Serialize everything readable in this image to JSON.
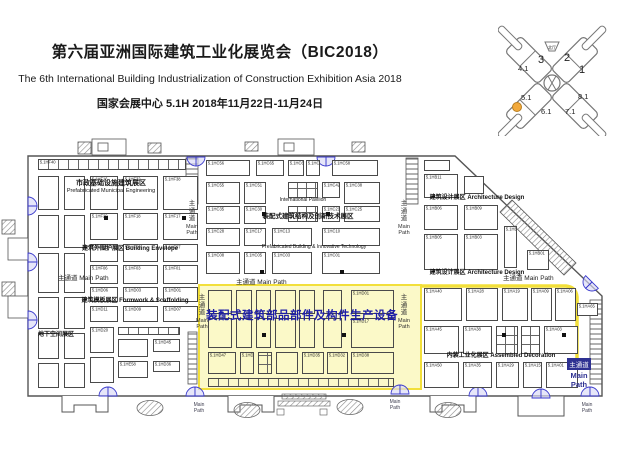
{
  "header": {
    "title_cn": "第六届亚洲国际建筑工业化展览会（BIC2018）",
    "title_en": "The 6th International Building Industrialization of Construction Exhibition Asia 2018",
    "venue_line": "国家会展中心 5.1H 2018年11月22日-11月24日"
  },
  "hall_map": {
    "north": "北厅",
    "labels": [
      {
        "t": "3",
        "x": 40,
        "y": 53,
        "fs": 11
      },
      {
        "t": "2",
        "x": 66,
        "y": 51,
        "fs": 11
      },
      {
        "t": "4.1",
        "x": 20,
        "y": 61,
        "fs": 7.5
      },
      {
        "t": "1",
        "x": 81,
        "y": 63,
        "fs": 11
      },
      {
        "t": "5.1",
        "x": 23,
        "y": 90,
        "fs": 7.5
      },
      {
        "t": "8.1",
        "x": 80,
        "y": 89,
        "fs": 7.5
      },
      {
        "t": "6.1",
        "x": 43,
        "y": 104,
        "fs": 7.5
      },
      {
        "t": "7.1",
        "x": 67,
        "y": 104,
        "fs": 7.5
      }
    ],
    "dot": [
      19,
      97
    ]
  },
  "colors": {
    "yellow-fill": "#FBF9C8",
    "yellow-line": "#F2DF3A",
    "highlight-text": "#1D1DA8",
    "door": "#3A3ACC",
    "dot": "#F2A93B"
  },
  "plan": {
    "highlight_zone_title": "装配式建筑部品部件及构件生产设备",
    "highlight_zone": {
      "x": 198,
      "y": 284,
      "w": 224,
      "h": 106
    },
    "zone_labels": [
      {
        "t": "市政基础设施建筑展区",
        "x": 36,
        "y": 180,
        "w": 150,
        "fs": 7,
        "b": 1
      },
      {
        "t": "Prefabricated Municipal Engineering",
        "x": 16,
        "y": 189,
        "w": 190,
        "fs": 5.5,
        "b": 0
      },
      {
        "t": "建筑外围护展区 Building Envelope",
        "x": 55,
        "y": 246,
        "w": 150,
        "fs": 6,
        "b": 1
      },
      {
        "t": "建筑模板展区 Formwork & Scaffolding",
        "x": 60,
        "y": 298,
        "w": 150,
        "fs": 6,
        "b": 1
      },
      {
        "t": "地下空间展区",
        "x": 30,
        "y": 332,
        "w": 52,
        "fs": 6,
        "b": 1
      },
      {
        "t": "International Pavilion",
        "x": 268,
        "y": 198,
        "w": 70,
        "fs": 5,
        "b": 0
      },
      {
        "t": "装配式建筑结构及创新技术展区",
        "x": 246,
        "y": 214,
        "w": 124,
        "fs": 6.5,
        "b": 1
      },
      {
        "t": "Prefabricated Building & Innovative Technology",
        "x": 236,
        "y": 245,
        "w": 156,
        "fs": 5,
        "b": 0
      },
      {
        "t": "建筑设计展区 Architecture Design",
        "x": 414,
        "y": 195,
        "w": 126,
        "fs": 6,
        "b": 1
      },
      {
        "t": "建筑设计展区 Architecture Design",
        "x": 414,
        "y": 270,
        "w": 126,
        "fs": 6,
        "b": 1
      },
      {
        "t": "内装工业化展区 Assembled Decoration",
        "x": 434,
        "y": 353,
        "w": 134,
        "fs": 6,
        "b": 1
      }
    ],
    "main_path": {
      "cn": "主通道",
      "en": "Main Path",
      "horizontal": [
        [
          58,
          272
        ],
        [
          236,
          276
        ],
        [
          503,
          272
        ]
      ],
      "vertical": [
        [
          184,
          200
        ],
        [
          194,
          294
        ],
        [
          396,
          200
        ],
        [
          396,
          294
        ]
      ],
      "small": [
        [
          186,
          403
        ],
        [
          382,
          400
        ],
        [
          574,
          403
        ]
      ],
      "badge": [
        564,
        354
      ]
    },
    "markers": [
      [
        104,
        216
      ],
      [
        182,
        216
      ],
      [
        262,
        212
      ],
      [
        326,
        212
      ],
      [
        260,
        270
      ],
      [
        340,
        270
      ],
      [
        262,
        333
      ],
      [
        342,
        333
      ],
      [
        502,
        333
      ],
      [
        562,
        333
      ]
    ],
    "booths": [
      [
        38,
        159,
        148,
        11,
        "5.1HF40",
        "s"
      ],
      [
        38,
        176,
        21,
        34,
        ""
      ],
      [
        64,
        176,
        21,
        34,
        ""
      ],
      [
        90,
        176,
        28,
        34,
        "5.1HF16"
      ],
      [
        123,
        176,
        35,
        34,
        "5.1HF32"
      ],
      [
        163,
        176,
        35,
        34,
        "5.1HF38"
      ],
      [
        38,
        215,
        21,
        33,
        ""
      ],
      [
        64,
        215,
        21,
        33,
        ""
      ],
      [
        90,
        213,
        28,
        27,
        "5.1HF29"
      ],
      [
        123,
        213,
        35,
        27,
        "5.1HF18"
      ],
      [
        163,
        213,
        35,
        27,
        "5.1HF17"
      ],
      [
        38,
        253,
        21,
        40,
        ""
      ],
      [
        64,
        253,
        21,
        40,
        ""
      ],
      [
        90,
        244,
        28,
        18,
        "5.1HF15"
      ],
      [
        123,
        244,
        35,
        18,
        "5.1HF09"
      ],
      [
        163,
        244,
        35,
        18,
        "5.1HF07"
      ],
      [
        90,
        265,
        28,
        19,
        "5.1HF06"
      ],
      [
        123,
        265,
        35,
        19,
        "5.1HF03"
      ],
      [
        163,
        265,
        35,
        19,
        "5.1HF01"
      ],
      [
        38,
        297,
        21,
        32,
        ""
      ],
      [
        64,
        297,
        21,
        32,
        ""
      ],
      [
        90,
        287,
        28,
        15,
        "5.1HD06"
      ],
      [
        123,
        287,
        35,
        15,
        "5.1HD03"
      ],
      [
        163,
        287,
        35,
        15,
        "5.1HD01"
      ],
      [
        90,
        306,
        28,
        16,
        "5.1HD11"
      ],
      [
        123,
        306,
        35,
        16,
        "5.1HD09"
      ],
      [
        163,
        306,
        35,
        16,
        "5.1HD07"
      ],
      [
        38,
        333,
        21,
        26,
        ""
      ],
      [
        64,
        333,
        21,
        26,
        ""
      ],
      [
        90,
        327,
        24,
        26,
        "5.1HD20"
      ],
      [
        118,
        327,
        62,
        8,
        "",
        "s"
      ],
      [
        118,
        339,
        30,
        18,
        ""
      ],
      [
        153,
        339,
        27,
        13,
        "5.1HD45"
      ],
      [
        118,
        361,
        30,
        17,
        "5.1HE58"
      ],
      [
        153,
        361,
        27,
        11,
        "5.1HD36"
      ],
      [
        38,
        363,
        21,
        25,
        ""
      ],
      [
        64,
        363,
        21,
        25,
        ""
      ],
      [
        90,
        357,
        24,
        26,
        ""
      ],
      [
        206,
        160,
        44,
        16,
        "5.1HC56"
      ],
      [
        256,
        160,
        28,
        16,
        "5.1HC65"
      ],
      [
        288,
        160,
        16,
        16,
        "5.1HC62"
      ],
      [
        306,
        160,
        14,
        16,
        "5.1HC80"
      ],
      [
        332,
        160,
        46,
        16,
        "5.1HC58"
      ],
      [
        206,
        182,
        34,
        22,
        "5.1HC55"
      ],
      [
        244,
        182,
        22,
        22,
        "5.1HC51"
      ],
      [
        288,
        182,
        30,
        16,
        "",
        "g"
      ],
      [
        322,
        182,
        18,
        16,
        "5.1HC42"
      ],
      [
        344,
        182,
        36,
        22,
        "5.1HC38"
      ],
      [
        206,
        206,
        34,
        18,
        "5.1HC35"
      ],
      [
        244,
        206,
        22,
        18,
        "5.1HC30"
      ],
      [
        288,
        206,
        30,
        16,
        "",
        "g"
      ],
      [
        322,
        206,
        18,
        16,
        "5.1HC21"
      ],
      [
        344,
        206,
        36,
        16,
        "5.1HC25"
      ],
      [
        206,
        228,
        34,
        18,
        "5.1HC28"
      ],
      [
        244,
        228,
        22,
        18,
        "5.1HC17"
      ],
      [
        272,
        228,
        40,
        18,
        "5.1HC13"
      ],
      [
        322,
        228,
        58,
        18,
        "5.1HC10"
      ],
      [
        206,
        252,
        34,
        22,
        "5.1HC08"
      ],
      [
        244,
        252,
        22,
        22,
        "5.1HC05"
      ],
      [
        272,
        252,
        40,
        22,
        "5.1HC03"
      ],
      [
        322,
        252,
        58,
        22,
        "5.1HC01"
      ],
      [
        424,
        160,
        26,
        11,
        ""
      ],
      [
        424,
        174,
        34,
        24,
        "5.1HB11"
      ],
      [
        464,
        176,
        20,
        18,
        ""
      ],
      [
        424,
        205,
        34,
        25,
        "5.1HB06"
      ],
      [
        464,
        205,
        34,
        25,
        "5.1HB09"
      ],
      [
        424,
        234,
        34,
        36,
        "5.1HB05"
      ],
      [
        464,
        234,
        34,
        36,
        "5.1HB03"
      ],
      [
        504,
        226,
        13,
        42,
        "5.1HB02"
      ],
      [
        527,
        250,
        22,
        20,
        "5.1HB01"
      ],
      [
        424,
        288,
        38,
        33,
        "5.1HA40"
      ],
      [
        466,
        288,
        32,
        33,
        "5.1HA28"
      ],
      [
        502,
        288,
        26,
        33,
        "5.1HA19"
      ],
      [
        531,
        288,
        21,
        33,
        "5.1HA09"
      ],
      [
        555,
        288,
        21,
        33,
        "5.1HA06"
      ],
      [
        577,
        303,
        21,
        13,
        "5.1HA65"
      ],
      [
        424,
        326,
        35,
        28,
        "5.1HA45"
      ],
      [
        463,
        326,
        29,
        28,
        "5.1HA38"
      ],
      [
        496,
        326,
        22,
        28,
        "",
        "g"
      ],
      [
        521,
        326,
        19,
        28,
        "",
        "g"
      ],
      [
        544,
        326,
        34,
        28,
        "5.1HA03"
      ],
      [
        424,
        362,
        35,
        26,
        "5.1HA50"
      ],
      [
        463,
        362,
        29,
        26,
        "5.1HA35"
      ],
      [
        496,
        362,
        23,
        26,
        "5.1HA29"
      ],
      [
        523,
        362,
        19,
        26,
        "5.1HA15"
      ],
      [
        546,
        362,
        32,
        26,
        "5.1HA01"
      ],
      [
        208,
        290,
        24,
        24,
        "",
        "y"
      ],
      [
        236,
        290,
        16,
        24,
        "",
        "y"
      ],
      [
        256,
        290,
        15,
        24,
        "",
        "y"
      ],
      [
        275,
        290,
        21,
        24,
        "",
        "y"
      ],
      [
        299,
        290,
        16,
        24,
        "",
        "y"
      ],
      [
        323,
        290,
        19,
        24,
        "",
        "y"
      ],
      [
        351,
        290,
        43,
        24,
        "5.1HD01",
        "y"
      ],
      [
        208,
        318,
        24,
        30,
        "",
        "y"
      ],
      [
        236,
        318,
        16,
        30,
        "",
        "y"
      ],
      [
        256,
        318,
        15,
        30,
        "",
        "y"
      ],
      [
        275,
        318,
        21,
        30,
        "",
        "y"
      ],
      [
        299,
        318,
        16,
        30,
        "",
        "y"
      ],
      [
        323,
        318,
        19,
        30,
        "",
        "y"
      ],
      [
        351,
        318,
        43,
        30,
        "5.1HD17",
        "y"
      ],
      [
        208,
        352,
        28,
        22,
        "5.1HD47",
        "y"
      ],
      [
        240,
        352,
        14,
        22,
        "5.1HD43",
        "y"
      ],
      [
        258,
        352,
        14,
        22,
        "",
        "yg"
      ],
      [
        276,
        352,
        22,
        22,
        "",
        "y"
      ],
      [
        302,
        352,
        22,
        22,
        "5.1HD35",
        "y"
      ],
      [
        327,
        352,
        21,
        22,
        "5.1HD32",
        "y"
      ],
      [
        351,
        352,
        43,
        22,
        "5.1HD38",
        "y"
      ],
      [
        208,
        378,
        186,
        9,
        "",
        "ys"
      ]
    ]
  }
}
